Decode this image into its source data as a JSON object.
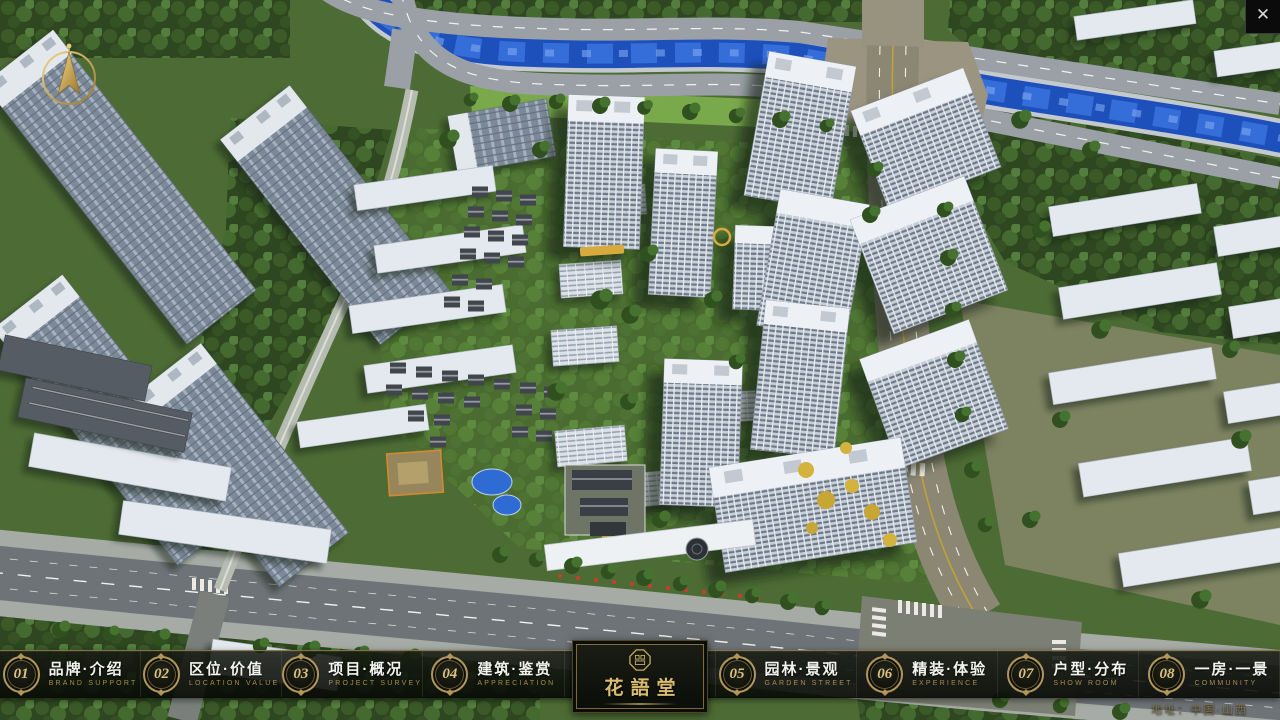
{
  "app": {
    "close_glyph": "✕",
    "address": "地址：中国·山西"
  },
  "logo": {
    "title": "花語堂"
  },
  "nav": {
    "items": [
      {
        "num": "01",
        "label": "品牌·介绍",
        "sub": "BRAND SUPPORT"
      },
      {
        "num": "02",
        "label": "区位·价值",
        "sub": "LOCATION VALUE"
      },
      {
        "num": "03",
        "label": "项目·概况",
        "sub": "PROJECT SURVEY"
      },
      {
        "num": "04",
        "label": "建筑·鉴赏",
        "sub": "APPRECIATION"
      },
      {
        "num": "05",
        "label": "园林·景观",
        "sub": "GARDEN STREET"
      },
      {
        "num": "06",
        "label": "精装·体验",
        "sub": "EXPERIENCE"
      },
      {
        "num": "07",
        "label": "户型·分布",
        "sub": "SHOW ROOM"
      },
      {
        "num": "08",
        "label": "一房·一景",
        "sub": "COMMUNITY"
      }
    ]
  },
  "colors": {
    "accent_gold": "#b3975a",
    "bar_background": "rgba(10,13,8,0.88)",
    "river_blue": "#2055c4",
    "label_white": "#f2f2ee",
    "sub_caption_gold": "#a68c52"
  }
}
